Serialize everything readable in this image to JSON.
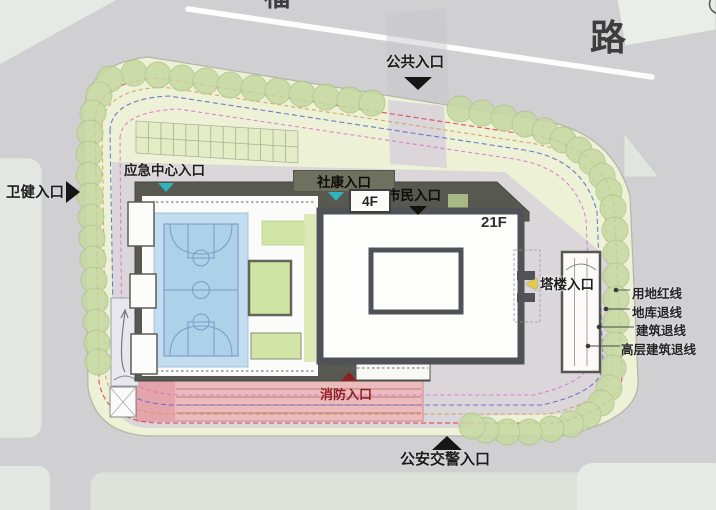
{
  "roads": {
    "name": "路",
    "name_partial": "福"
  },
  "entrances": {
    "public": "公共入口",
    "health": "卫健入口",
    "emergency": "应急中心入口",
    "community": "社康入口",
    "citizen": "市民入口",
    "tower": "塔楼入口",
    "fire": "消防入口",
    "police": "公安交警入口"
  },
  "buildings": {
    "podium_floors": "4F",
    "tower_floors": "21F"
  },
  "legend": {
    "items": [
      {
        "label": "用地红线",
        "color": "#e04b4b"
      },
      {
        "label": "地库退线",
        "color": "#d4984e"
      },
      {
        "label": "建筑退线",
        "color": "#5b64c4"
      },
      {
        "label": "高层建筑退线",
        "color": "#e06cc8"
      }
    ]
  },
  "colors": {
    "road": "#d0cfd2",
    "sidewalk": "#e5e7e2",
    "site_green": "#edf2d7",
    "paving": "#dad6da",
    "tree": "#c7d9a3",
    "podium_dark": "#575950",
    "court_blue": "#aed1ea",
    "roof_green": "#d2e5a6",
    "fire_lane_pink": "#ecbcbd",
    "arrow_teal": "#2fb3bd",
    "arrow_yellow": "#e3cc3f",
    "fire_red": "#8e1f1f"
  }
}
